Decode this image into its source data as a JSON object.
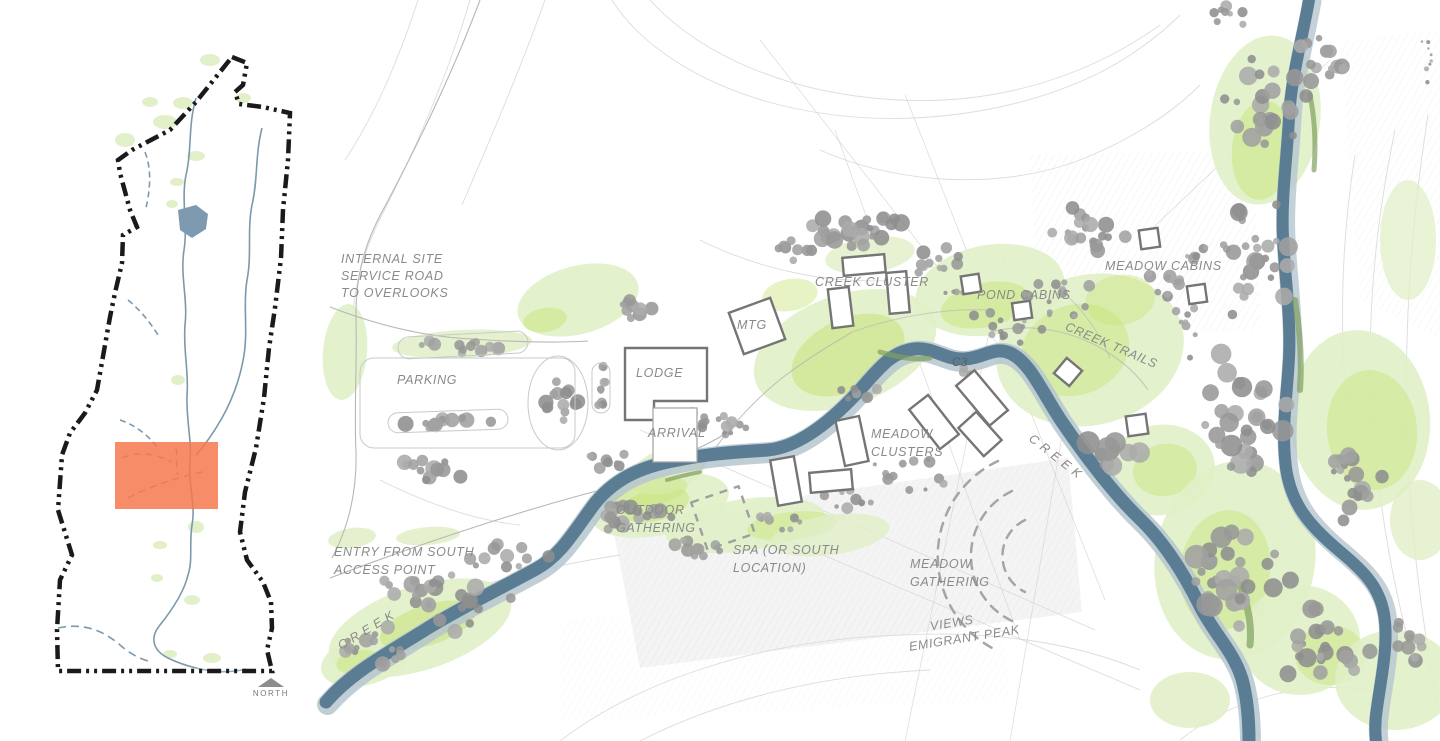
{
  "locator": {
    "north_label": "NORTH",
    "highlight_color": "#f5794d"
  },
  "site_plan": {
    "labels": {
      "internal_road": [
        "INTERNAL SITE",
        "SERVICE ROAD",
        "TO OVERLOOKS"
      ],
      "parking": "PARKING",
      "mtg": "MTG",
      "lodge": "LODGE",
      "arrival": "ARRIVAL",
      "creek_cluster": "CREEK CLUSTER",
      "pond_cabins": "POND CABINS",
      "meadow_cabins": "MEADOW CABINS",
      "creek_trails": "CREEK TRAILS",
      "c3": "C3",
      "meadow_clusters": [
        "MEADOW",
        "CLUSTERS"
      ],
      "outdoor_gathering": [
        "OUTDOOR",
        "GATHERING"
      ],
      "spa": [
        "SPA (OR SOUTH",
        "LOCATION)"
      ],
      "meadow_gathering": [
        "MEADOW",
        "GATHERING"
      ],
      "views_emigrant_peak": [
        "VIEWS",
        "EMIGRANT PEAK"
      ],
      "entry_south": [
        "ENTRY FROM SOUTH",
        "ACCESS POINT"
      ],
      "creek_southwest": "C R E E K",
      "creek_east": "C R E E K"
    },
    "colors": {
      "creek": "#5a7d93",
      "creek_edge": "#b5c5cf",
      "meadow_light": "#e0efc6",
      "meadow_bright": "#c9e57d",
      "olive_accent": "#7fa05e",
      "tree_gray": "#a0a0a0",
      "label_text": "#8a8a8a",
      "building_stroke": "#757575",
      "boundary_black": "#1a1a1a"
    }
  }
}
